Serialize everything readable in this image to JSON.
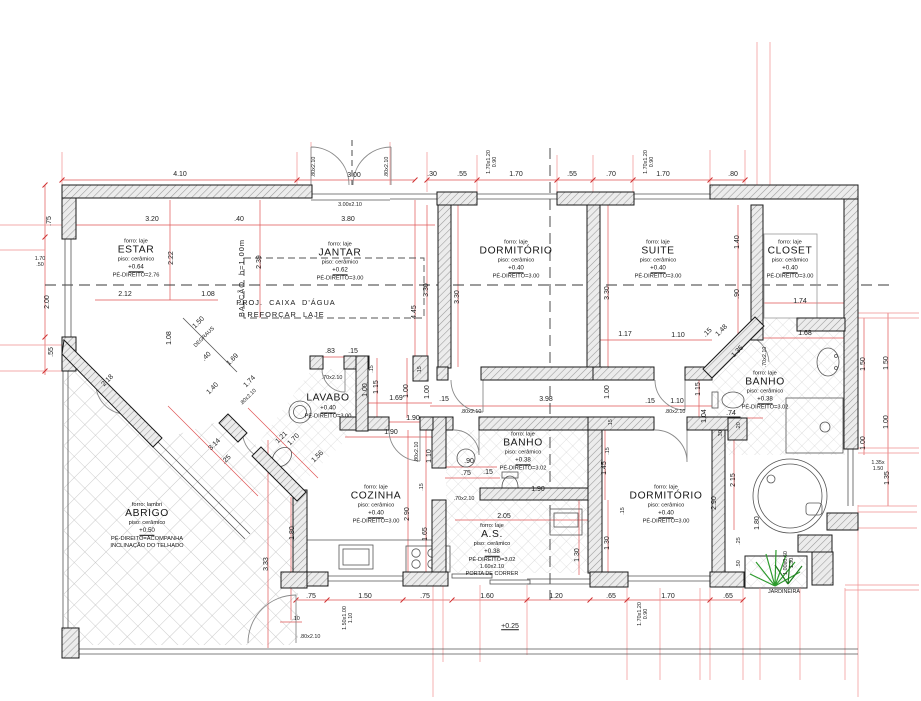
{
  "colors": {
    "dim_red": "#e05555",
    "ext_red": "#f08a8a",
    "wall_edge": "#1a1a1a",
    "plant_green": "#2d9b2d"
  },
  "rooms": [
    {
      "id": "estar",
      "cx": 136,
      "cy": 259,
      "lines": [
        [
          "sub",
          "forro: laje"
        ],
        [
          "title",
          "ESTAR"
        ],
        [
          "sub",
          "piso: cerâmico"
        ],
        [
          "lvl",
          "+0.64"
        ],
        [
          "sub",
          "PÉ-DIREITO=2.76"
        ]
      ]
    },
    {
      "id": "jantar",
      "cx": 340,
      "cy": 262,
      "lines": [
        [
          "sub",
          "forro: laje"
        ],
        [
          "title",
          "JANTAR"
        ],
        [
          "sub",
          "piso: cerâmico"
        ],
        [
          "lvl",
          "+0.62"
        ],
        [
          "sub",
          "PÉ-DIREITO=3.00"
        ]
      ]
    },
    {
      "id": "dormitorio-1",
      "cx": 516,
      "cy": 260,
      "lines": [
        [
          "sub",
          "forro: laje"
        ],
        [
          "title",
          "DORMITÓRIO"
        ],
        [
          "sub",
          "piso: cerâmico"
        ],
        [
          "lvl",
          "+0.40"
        ],
        [
          "sub",
          "PÉ-DIREITO=3.00"
        ]
      ]
    },
    {
      "id": "suite",
      "cx": 658,
      "cy": 260,
      "lines": [
        [
          "sub",
          "forro: laje"
        ],
        [
          "title",
          "SUITE"
        ],
        [
          "sub",
          "piso: cerâmico"
        ],
        [
          "lvl",
          "+0.40"
        ],
        [
          "sub",
          "PÉ-DIREITO=3.00"
        ]
      ]
    },
    {
      "id": "closet",
      "cx": 790,
      "cy": 260,
      "lines": [
        [
          "sub",
          "forro: laje"
        ],
        [
          "title",
          "CLOSET"
        ],
        [
          "sub",
          "piso: cerâmico"
        ],
        [
          "lvl",
          "+0.40"
        ],
        [
          "sub",
          "PÉ-DIREITO=3.00"
        ]
      ]
    },
    {
      "id": "lavabo",
      "cx": 328,
      "cy": 407,
      "lines": [
        [
          "title",
          "LAVABO"
        ],
        [
          "lvl",
          "+0.40"
        ],
        [
          "sub",
          "PÉ-DIREITO=3.00"
        ]
      ]
    },
    {
      "id": "banho-central",
      "cx": 523,
      "cy": 452,
      "lines": [
        [
          "sub",
          "forro: laje"
        ],
        [
          "title",
          "BANHO"
        ],
        [
          "sub",
          "piso: cerâmico"
        ],
        [
          "lvl",
          "+0.38"
        ],
        [
          "sub",
          "PÉ-DIREITO=3.02"
        ]
      ]
    },
    {
      "id": "banho-direita",
      "cx": 765,
      "cy": 391,
      "lines": [
        [
          "sub",
          "forro: laje"
        ],
        [
          "title",
          "BANHO"
        ],
        [
          "sub",
          "piso: cerâmico"
        ],
        [
          "lvl",
          "+0.38"
        ],
        [
          "sub",
          "PÉ-DIREITO=3.02"
        ]
      ]
    },
    {
      "id": "cozinha",
      "cx": 376,
      "cy": 505,
      "lines": [
        [
          "sub",
          "forro: laje"
        ],
        [
          "title",
          "COZINHA"
        ],
        [
          "sub",
          "piso: cerâmico"
        ],
        [
          "lvl",
          "+0.40"
        ],
        [
          "sub",
          "PÉ-DIREITO=3.00"
        ]
      ]
    },
    {
      "id": "area-servico",
      "cx": 492,
      "cy": 550,
      "lines": [
        [
          "sub",
          "forro: laje"
        ],
        [
          "title",
          "A.S."
        ],
        [
          "sub",
          "piso: cerâmico"
        ],
        [
          "lvl",
          "+0.38"
        ],
        [
          "sub",
          "PÉ-DIREITO=3.02"
        ],
        [
          "tiny",
          "1.60x2.10"
        ],
        [
          "tiny",
          "PORTA DE CORRER"
        ]
      ]
    },
    {
      "id": "dormitorio-2",
      "cx": 666,
      "cy": 505,
      "lines": [
        [
          "sub",
          "forro: laje"
        ],
        [
          "title",
          "DORMITÓRIO"
        ],
        [
          "sub",
          "piso: cerâmico"
        ],
        [
          "lvl",
          "+0.40"
        ],
        [
          "sub",
          "PÉ-DIREITO=3.00"
        ]
      ]
    },
    {
      "id": "abrigo",
      "cx": 147,
      "cy": 526,
      "lines": [
        [
          "sub",
          "forro: lambri"
        ],
        [
          "title",
          "ABRIGO"
        ],
        [
          "sub",
          "piso: cerâmico"
        ],
        [
          "lvl",
          "+0.50"
        ],
        [
          "sub",
          "PÉ-DIREITO=ACOMPANHA"
        ],
        [
          "sub",
          "INCLINAÇÃO DO TELHADO"
        ]
      ]
    }
  ],
  "labels": [
    {
      "t": "4.10",
      "x": 180,
      "y": 175
    },
    {
      "t": "3.00",
      "x": 354,
      "y": 176
    },
    {
      "t": ".30",
      "x": 432,
      "y": 175
    },
    {
      "t": ".55",
      "x": 462,
      "y": 175
    },
    {
      "t": "1.70",
      "x": 516,
      "y": 175
    },
    {
      "t": ".55",
      "x": 572,
      "y": 175
    },
    {
      "t": ".70",
      "x": 611,
      "y": 175
    },
    {
      "t": "1.70",
      "x": 663,
      "y": 175
    },
    {
      "t": ".80",
      "x": 733,
      "y": 175
    },
    {
      "t": "3.20",
      "x": 152,
      "y": 220
    },
    {
      "t": ".40",
      "x": 239,
      "y": 220
    },
    {
      "t": "3.80",
      "x": 348,
      "y": 220
    },
    {
      "t": "2.12",
      "x": 125,
      "y": 295
    },
    {
      "t": "1.08",
      "x": 208,
      "y": 295
    },
    {
      "t": ".83",
      "x": 330,
      "y": 352
    },
    {
      "t": ".15",
      "x": 353,
      "y": 352
    },
    {
      "t": "1.69",
      "x": 396,
      "y": 399
    },
    {
      "t": "1.90",
      "x": 413,
      "y": 419
    },
    {
      "t": "1.90",
      "x": 391,
      "y": 433
    },
    {
      "t": "3.98",
      "x": 546,
      "y": 400
    },
    {
      "t": ".15",
      "x": 444,
      "y": 400
    },
    {
      "t": ".15",
      "x": 650,
      "y": 402
    },
    {
      "t": "1.10",
      "x": 677,
      "y": 402
    },
    {
      "t": ".90",
      "x": 469,
      "y": 462
    },
    {
      "t": ".75",
      "x": 466,
      "y": 474
    },
    {
      "t": ".15",
      "x": 488,
      "y": 473
    },
    {
      "t": "1.90",
      "x": 538,
      "y": 490
    },
    {
      "t": "2.05",
      "x": 504,
      "y": 517
    },
    {
      "t": "1.17",
      "x": 625,
      "y": 335
    },
    {
      "t": "1.10",
      "x": 678,
      "y": 336
    },
    {
      "t": ".15",
      "x": 708,
      "y": 333,
      "r": -45
    },
    {
      "t": "1.48",
      "x": 722,
      "y": 331,
      "r": -45
    },
    {
      "t": "1.74",
      "x": 800,
      "y": 302
    },
    {
      "t": "1.68",
      "x": 805,
      "y": 334
    },
    {
      "t": ".74",
      "x": 731,
      "y": 414
    },
    {
      "t": ".75",
      "x": 311,
      "y": 597
    },
    {
      "t": "1.50",
      "x": 365,
      "y": 597
    },
    {
      "t": ".75",
      "x": 425,
      "y": 597
    },
    {
      "t": "1.60",
      "x": 487,
      "y": 597
    },
    {
      "t": "1.20",
      "x": 556,
      "y": 597
    },
    {
      "t": ".65",
      "x": 611,
      "y": 597
    },
    {
      "t": "1.70",
      "x": 668,
      "y": 597
    },
    {
      "t": ".65",
      "x": 728,
      "y": 597
    },
    {
      "t": ".10",
      "x": 296,
      "y": 620,
      "c": "t"
    },
    {
      "t": "+0.25",
      "x": 510,
      "y": 627,
      "c": "lv"
    },
    {
      "t": ".75",
      "x": 50,
      "y": 221,
      "r": -90
    },
    {
      "t": "2.00",
      "x": 48,
      "y": 302,
      "r": -90
    },
    {
      "t": ".55",
      "x": 52,
      "y": 352,
      "r": -90
    },
    {
      "t": "2.22",
      "x": 172,
      "y": 258,
      "r": -90
    },
    {
      "t": "2.39",
      "x": 260,
      "y": 262,
      "r": -90
    },
    {
      "t": "4.45",
      "x": 415,
      "y": 312,
      "r": -90
    },
    {
      "t": "3.30",
      "x": 427,
      "y": 290,
      "r": -90
    },
    {
      "t": "3.30",
      "x": 458,
      "y": 297,
      "r": -90
    },
    {
      "t": "3.30",
      "x": 608,
      "y": 293,
      "r": -90
    },
    {
      "t": "1.40",
      "x": 738,
      "y": 242,
      "r": -90
    },
    {
      "t": ".90",
      "x": 738,
      "y": 294,
      "r": -90
    },
    {
      "t": "1.50",
      "x": 887,
      "y": 363,
      "r": -90
    },
    {
      "t": "1.00",
      "x": 887,
      "y": 422,
      "r": -90
    },
    {
      "t": "1.35",
      "x": 888,
      "y": 478,
      "r": -90
    },
    {
      "t": "1.50",
      "x": 864,
      "y": 364,
      "r": -90
    },
    {
      "t": "1.00",
      "x": 864,
      "y": 443,
      "r": -90
    },
    {
      "t": "2.90",
      "x": 408,
      "y": 514,
      "r": -90
    },
    {
      "t": "1.65",
      "x": 426,
      "y": 534,
      "r": -90
    },
    {
      "t": "1.10",
      "x": 430,
      "y": 456,
      "r": -90
    },
    {
      "t": "2.15",
      "x": 734,
      "y": 480,
      "r": -90
    },
    {
      "t": "2.90",
      "x": 715,
      "y": 503,
      "r": -90
    },
    {
      "t": "1.80",
      "x": 758,
      "y": 523,
      "r": -90
    },
    {
      "t": "1.30",
      "x": 608,
      "y": 543,
      "r": -90
    },
    {
      "t": "1.30",
      "x": 578,
      "y": 555,
      "r": -90
    },
    {
      "t": "3.33",
      "x": 267,
      "y": 564,
      "r": -90
    },
    {
      "t": "1.80",
      "x": 293,
      "y": 533,
      "r": -90
    },
    {
      "t": "1.00",
      "x": 366,
      "y": 390,
      "r": -90
    },
    {
      "t": "1.15",
      "x": 377,
      "y": 387,
      "r": -90
    },
    {
      "t": "1.00",
      "x": 407,
      "y": 391,
      "r": -90
    },
    {
      "t": "1.00",
      "x": 428,
      "y": 392,
      "r": -90
    },
    {
      "t": "1.00",
      "x": 608,
      "y": 392,
      "r": -90
    },
    {
      "t": "1.15",
      "x": 699,
      "y": 389,
      "r": -90
    },
    {
      "t": "1.45",
      "x": 605,
      "y": 468,
      "r": -90
    },
    {
      "t": "1.04",
      "x": 705,
      "y": 416,
      "r": -90
    },
    {
      "t": ".20",
      "x": 740,
      "y": 426,
      "r": -90,
      "c": "t"
    },
    {
      "t": ".30",
      "x": 722,
      "y": 434,
      "r": -90,
      "c": "t"
    },
    {
      "t": "1.08",
      "x": 170,
      "y": 338,
      "r": -90
    },
    {
      "t": ".15",
      "x": 373,
      "y": 369,
      "r": -90,
      "c": "t"
    },
    {
      "t": ".15",
      "x": 421,
      "y": 370,
      "r": -90,
      "c": "t"
    },
    {
      "t": ".15",
      "x": 612,
      "y": 423,
      "r": -90,
      "c": "t"
    },
    {
      "t": ".15",
      "x": 624,
      "y": 511,
      "r": -90,
      "c": "t"
    },
    {
      "t": ".15",
      "x": 609,
      "y": 451,
      "r": -90,
      "c": "t"
    },
    {
      "t": ".25",
      "x": 740,
      "y": 541,
      "r": -90,
      "c": "t"
    },
    {
      "t": ".50",
      "x": 740,
      "y": 564,
      "r": -90,
      "c": "t"
    },
    {
      "t": ".15",
      "x": 423,
      "y": 487,
      "r": -90,
      "c": "t"
    },
    {
      "t": "2.18",
      "x": 108,
      "y": 381,
      "r": -45
    },
    {
      "t": "3.14",
      "x": 215,
      "y": 445,
      "r": -45
    },
    {
      "t": "1.50",
      "x": 199,
      "y": 323,
      "r": -45
    },
    {
      "t": ".40",
      "x": 207,
      "y": 357,
      "r": -45
    },
    {
      "t": "1.69",
      "x": 233,
      "y": 360,
      "r": -45
    },
    {
      "t": "1.40",
      "x": 213,
      "y": 389,
      "r": -45
    },
    {
      "t": "1.74",
      "x": 250,
      "y": 382,
      "r": -45
    },
    {
      "t": "1.35",
      "x": 738,
      "y": 352,
      "r": -45
    },
    {
      "t": ".25",
      "x": 227,
      "y": 460,
      "r": -45
    },
    {
      "t": "1.21",
      "x": 282,
      "y": 438,
      "r": -45
    },
    {
      "t": "1.70",
      "x": 294,
      "y": 440,
      "r": -45
    },
    {
      "t": "1.56",
      "x": 318,
      "y": 457,
      "r": -45
    },
    {
      "t": ".80x2.10",
      "x": 315,
      "y": 167,
      "r": -90,
      "c": "t"
    },
    {
      "t": ".80x2.10",
      "x": 388,
      "y": 167,
      "r": -90,
      "c": "t"
    },
    {
      "t": "3.00x2.10",
      "x": 350,
      "y": 206,
      "c": "t"
    },
    {
      "t": "1.70x1.20\n0.90",
      "x": 493,
      "y": 162,
      "r": -90,
      "c": "t"
    },
    {
      "t": "1.70x1.20\n0.90",
      "x": 650,
      "y": 162,
      "r": -90,
      "c": "t"
    },
    {
      "t": "1.70\n.50",
      "x": 40,
      "y": 263,
      "c": "t"
    },
    {
      "t": ".70x2.10",
      "x": 332,
      "y": 379,
      "c": "t"
    },
    {
      "t": ".80x2.10",
      "x": 471,
      "y": 413,
      "c": "t"
    },
    {
      "t": ".80x2.10",
      "x": 675,
      "y": 413,
      "c": "t"
    },
    {
      "t": ".70x2.10",
      "x": 464,
      "y": 500,
      "c": "t"
    },
    {
      "t": ".80x2.10",
      "x": 418,
      "y": 452,
      "r": -90,
      "c": "t"
    },
    {
      "t": ".80x2.10",
      "x": 249,
      "y": 398,
      "r": -45,
      "c": "t"
    },
    {
      "t": ".70x2.10",
      "x": 766,
      "y": 357,
      "r": -90,
      "c": "t"
    },
    {
      "t": "1.35x\n1.50",
      "x": 878,
      "y": 467,
      "c": "t"
    },
    {
      "t": "1.50x1.00\n1.10",
      "x": 349,
      "y": 618,
      "r": -90,
      "c": "t"
    },
    {
      "t": "1.70x1.20\n0.90",
      "x": 644,
      "y": 614,
      "r": -90,
      "c": "t"
    },
    {
      "t": "1.00x0.60\n1.30",
      "x": 790,
      "y": 563,
      "r": -90,
      "c": "t"
    },
    {
      "t": ".80x2.10",
      "x": 310,
      "y": 638,
      "c": "t"
    },
    {
      "t": "BALCÃO  h=1.00m",
      "x": 242,
      "y": 278,
      "r": -90,
      "c": "a"
    },
    {
      "t": "PROJ.  CAIXA  D'ÁGUA",
      "x": 286,
      "y": 303,
      "c": "a"
    },
    {
      "t": "REFORÇAR  LAJE",
      "x": 286,
      "y": 315,
      "c": "a"
    },
    {
      "t": "DEGRAUS",
      "x": 205,
      "y": 338,
      "r": -45,
      "c": "t"
    },
    {
      "t": "JARDINEIRA",
      "x": 784,
      "y": 593,
      "c": "t"
    }
  ]
}
